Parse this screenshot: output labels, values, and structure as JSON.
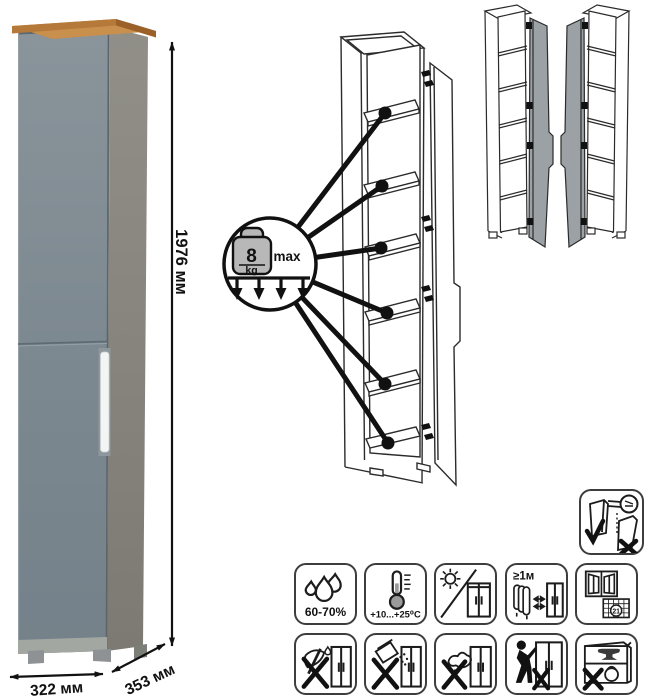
{
  "product": {
    "dimensions": {
      "height": "1976 мм",
      "width": "322 мм",
      "depth": "353 мм"
    },
    "colors": {
      "door": "#7e8a90",
      "side": "#8c8982",
      "top_wood": "#c28445",
      "handle": "#f4f5f5"
    }
  },
  "load_callout": {
    "value": "8",
    "unit": "kg",
    "max_label": "max",
    "shelf_points": 6
  },
  "care": {
    "humidity": "60-70%",
    "temperature": "+10...+25⁰C",
    "heater_distance": "≥1м",
    "calendar_day": "21"
  }
}
